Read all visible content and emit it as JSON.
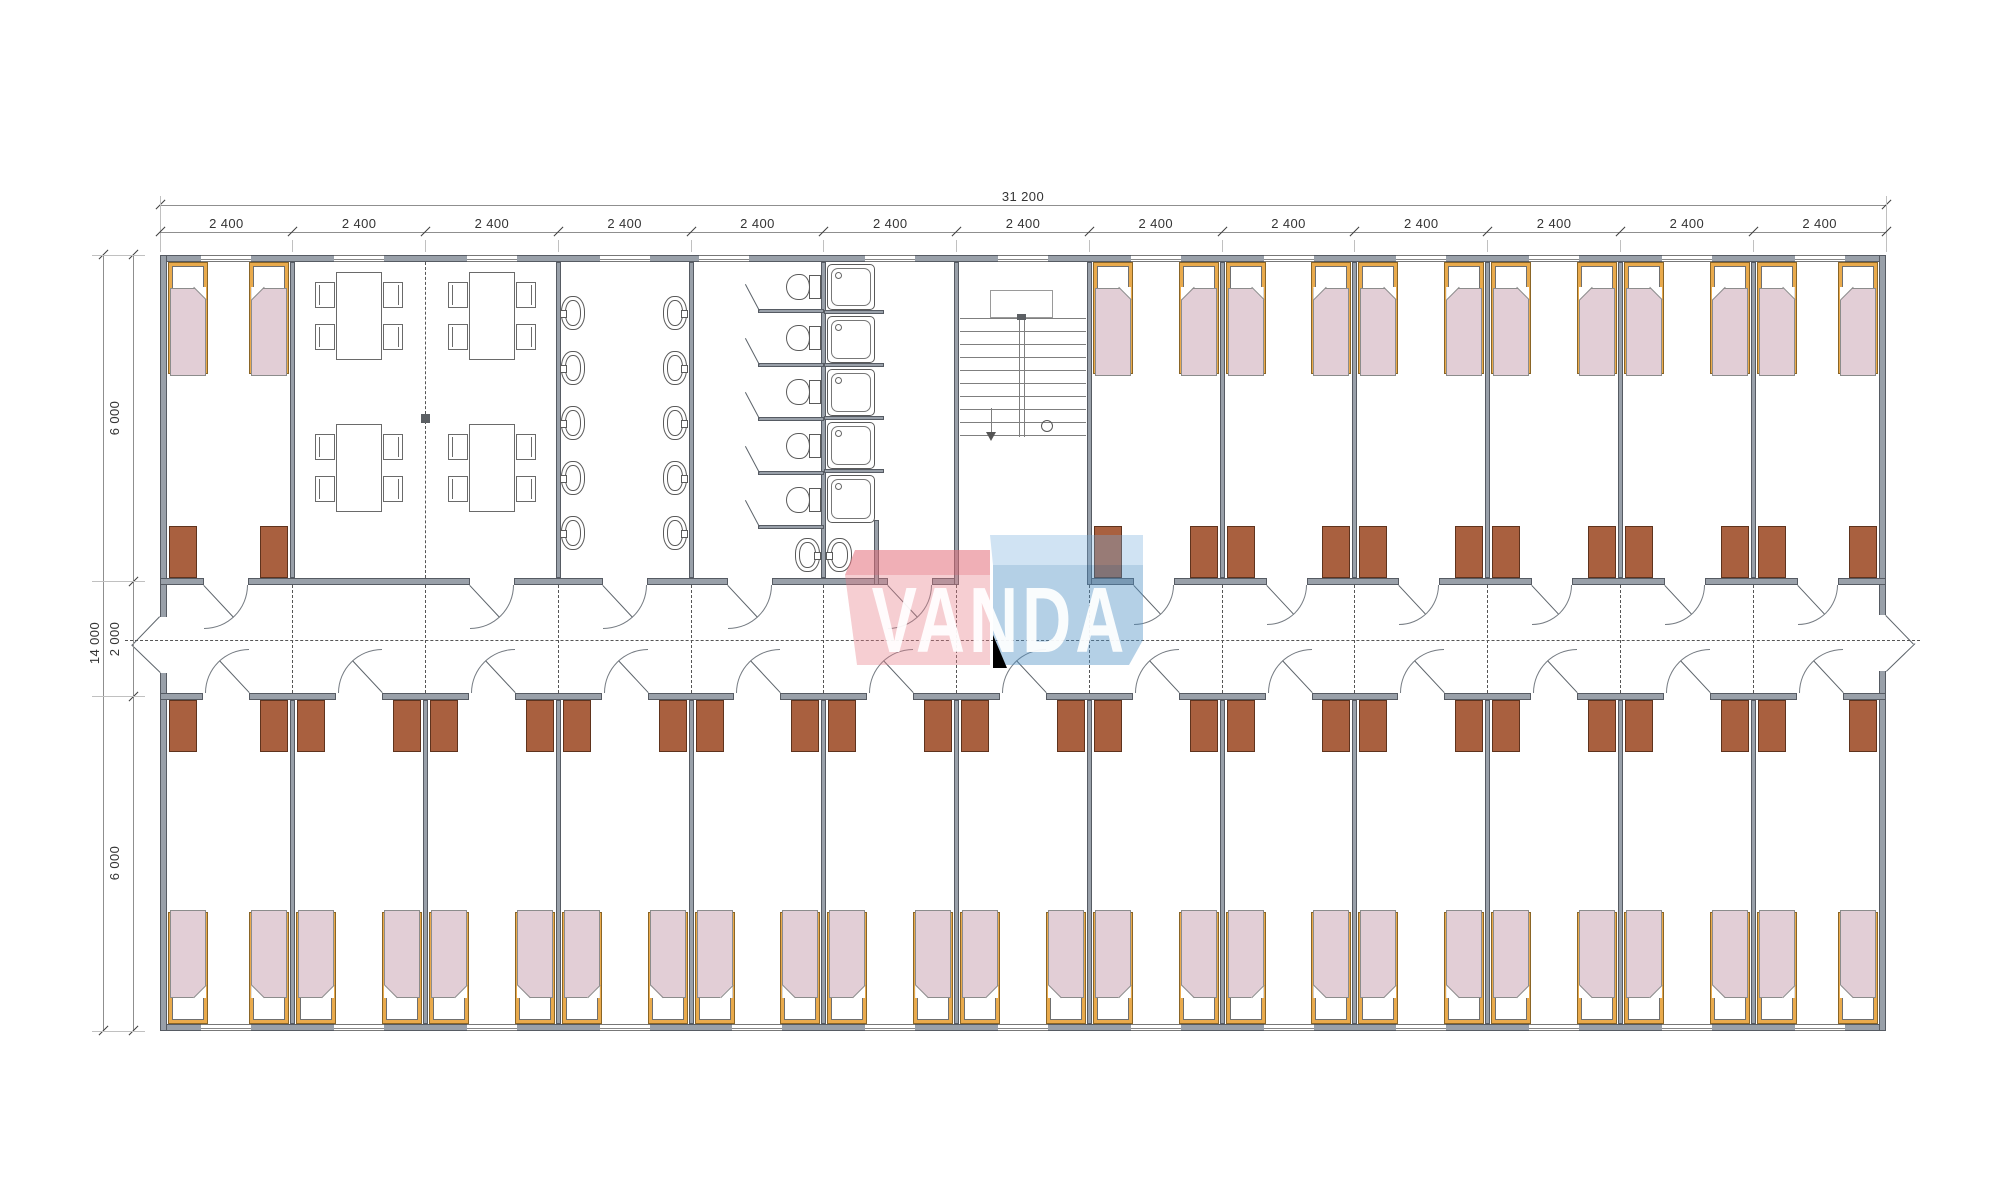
{
  "drawing": {
    "type": "floor-plan",
    "building": "modular dormitory block, 13 bays x 2400 mm",
    "rooms": {
      "top_row": [
        "bedroom",
        "dining-room",
        "dining-room",
        "washroom",
        "toilet-room",
        "shower-room",
        "staircase",
        "bedroom",
        "bedroom",
        "bedroom",
        "bedroom",
        "bedroom",
        "bedroom"
      ],
      "bottom_row": [
        "bedroom",
        "bedroom",
        "bedroom",
        "bedroom",
        "bedroom",
        "bedroom",
        "bedroom",
        "bedroom",
        "bedroom",
        "bedroom",
        "bedroom",
        "bedroom",
        "bedroom"
      ]
    }
  },
  "dimensions": {
    "overall_width_label": "31 200",
    "bay_width_label": "2 400",
    "bay_count": 13,
    "overall_height_label": "14 000",
    "height_segment_labels": [
      "6 000",
      "2 000",
      "6 000"
    ]
  },
  "logo": {
    "text": "VANDA",
    "text_color": "rgba(255,255,255,0.92)",
    "red_body": "rgba(232,126,136,0.38)",
    "red_top": "rgba(228,110,122,0.55)",
    "blue_body": "rgba(77,143,196,0.42)",
    "blue_top": "rgba(120,175,220,0.35)"
  },
  "palette": {
    "wall": "#99a0a9",
    "walledge": "#565b63",
    "wardrobe": "#a9603f",
    "wardrobeedge": "#5f331d",
    "bedframe": "#e9aa4c",
    "bedframeedge": "#8a6526",
    "blanket": "#e2ced6",
    "blanketedge": "#8c8c8c"
  }
}
